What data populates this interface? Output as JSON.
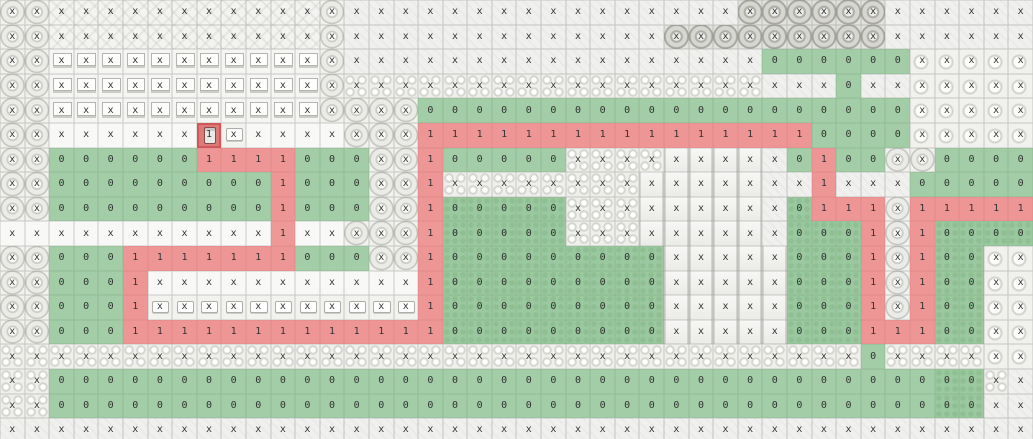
{
  "map": {
    "cols": 42,
    "rows": 18,
    "cell_size_px": 24.6,
    "legend": {
      "x": "blocked tile",
      "0": "walkable tile",
      "1": "path tile"
    },
    "colors": {
      "walkable_overlay": "#92cb9f",
      "path_overlay": "#f09090",
      "player_cell": "#de6868",
      "grid_line": "#8c8c8c",
      "label_text": "#333333",
      "ground": "#f0f0ee"
    },
    "player": {
      "row": 5,
      "col": 8,
      "label": "1"
    },
    "labels": [
      "xxxxxxxxxxxxxxxxxxxxxxxxxxxxxxxxxxxxxxxxxx",
      "xxxxxxxxxxxxxxxxxxxxxxxxxxxxxxxxxxxxxxxxxx",
      "xxxxxxxxxxxxxxxxxxxxxxxxxxxxxxx000000xxxxx",
      "xxxxxxxxxxxxxxxxxxxxxxxxxxxxxxxxxx0xxxxxxx",
      "xxxxxxxxxxxxxxxxx00000000000000000000xxxxx",
      "xxxxxxxx1xxxxxxxx11111111111111110000xxxxx",
      "xx0000001111000xx100000xxxxxxxxx0100xx0000",
      "xx0000000001000xx1xxxxxxxxxxxxxxx1xxx00000",
      "xx0000000001000xx100000xxxxxxxxx0111x11111",
      "xxxxxxxxxxx1xxxxx100000xxxxxxxxx0001x10000",
      "xx0001111111000xx1000000000xxxxx0001x100xx",
      "xx0001xxxxxxxxxxx1000000000xxxxx0001x100xx",
      "xx0001xxxxxxxxxxx1000000000xxxxx0001x100xx",
      "xx0001111111111111000000000xxxxx00011100xx",
      "xxxxxxxxxxxxxxxxxxxxxxxxxxxxxxxxxxx0xxxxxx",
      "xx00000000000000000000000000000000000000xx",
      "xx00000000000000000000000000000000000000xx",
      "xxxxxxxxxxxxxxxxxxxxxxxxxxxxxxxxxxxxxxxxxx"
    ],
    "terrain": [
      "ttwwwwwwwwwwwtppppppppppppppppTTTTTTpppppp",
      "ttwwwwwwwwwwwtpppppppppppppTTTTTTTTTpppppp",
      "ttdddddddddddtpppppppppppppppppggggggccccc",
      "ttdddddddddddthhhhhhhhhhhhhhhhhpppgppccccc",
      "ttdddddddddddttttggggggggggggggggggggccccc",
      "ttPPPPPPYiPPPPtttggggggggggggggggggggccccc",
      "ttgggggggggggggttgggggghhhhbbbbpggggttgggg",
      "ttgggggggggggggttghhhhhhhhbbbbbppgpppggggg",
      "ttgggggggggggggttgGGGGGhhhbbbbbpGgggtggggg",
      "PPPPPPPPPPPPPPtttPGGGGGhhhbbbbbpGGGgtgGGGG",
      "ttgggggggggggggttgGGGGGGGGGbbbbbGGGgtgGGcc",
      "ttggggPPPPPPPPPPPgGGGGGGGGGbbbbbGGGgtgGGcc",
      "ttggggiiiiiiiiiiigGGGGGGGGGbbbbbGGGgtgGGcc",
      "ttggggggggggggggggGGGGGGGGGbbbbbGGGgggGGcc",
      "hhhhhhhhhhhhhhhhhhhhhhhhhhhhhhhhhhhghhhhcc",
      "hhggggggggggggggggggggggggggggggggggggGGhp",
      "hhggggggggggggggggggggggggggggggggggggGGpp",
      "pppppppppppppppppppppppppppppppppppppppppp"
    ]
  }
}
